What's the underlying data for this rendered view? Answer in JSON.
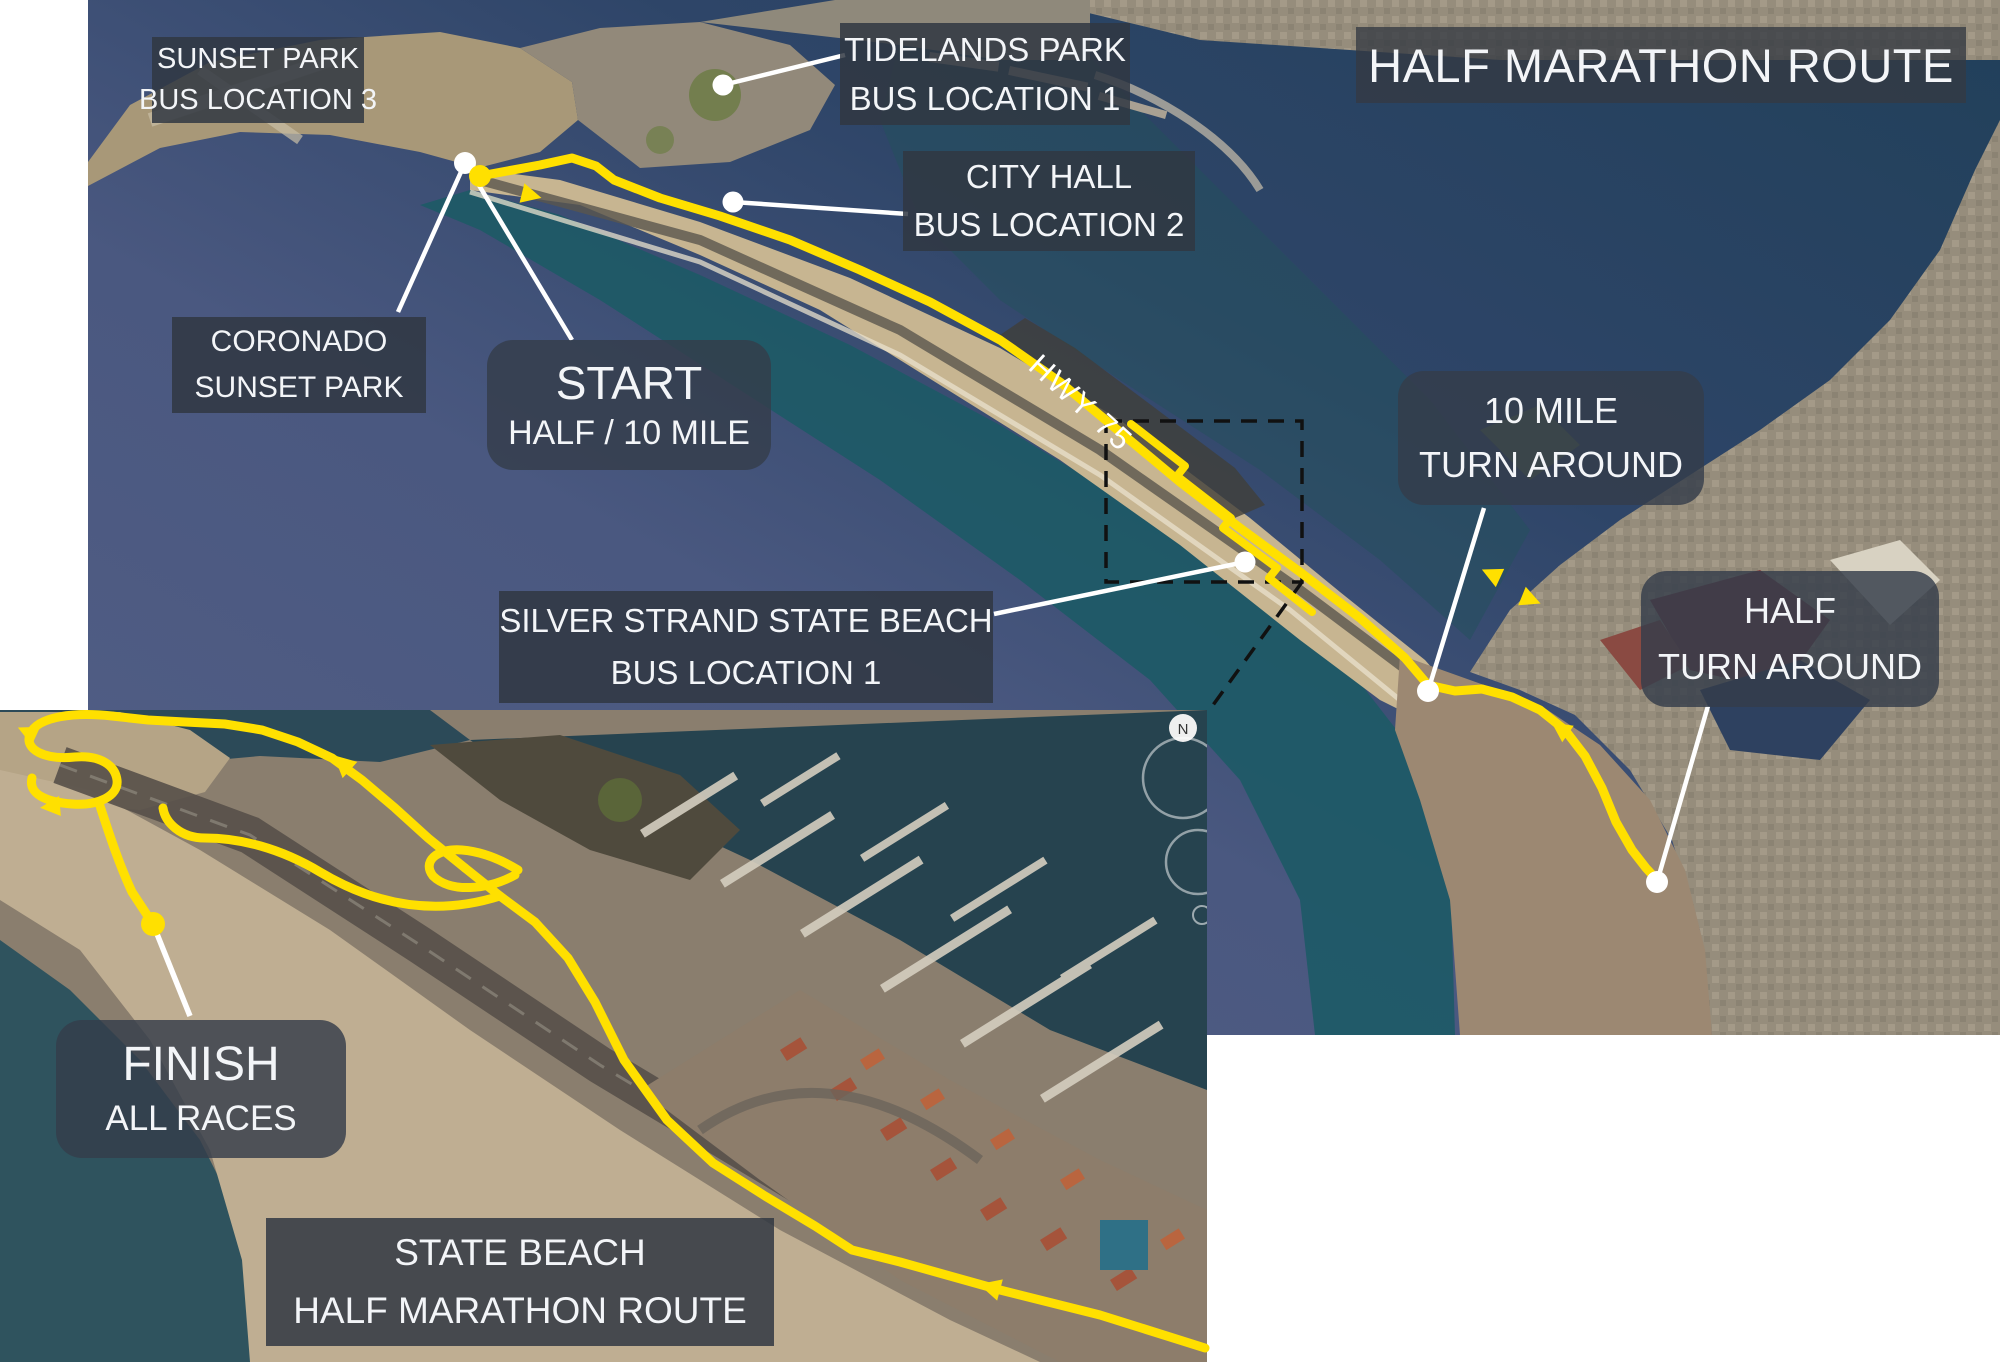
{
  "title": "HALF MARATHON ROUTE",
  "labels": {
    "sunset_park_bus": {
      "line1": "SUNSET PARK",
      "line2": "BUS LOCATION 3"
    },
    "tidelands_park_bus": {
      "line1": "TIDELANDS PARK",
      "line2": "BUS LOCATION 1"
    },
    "city_hall_bus": {
      "line1": "CITY HALL",
      "line2": "BUS LOCATION 2"
    },
    "coronado_sunset_park": {
      "line1": "CORONADO",
      "line2": "SUNSET PARK"
    },
    "start": {
      "line1": "START",
      "line2": "HALF / 10 MILE"
    },
    "hwy_75": "HWY 75",
    "ten_mile_turnaround": {
      "line1": "10 MILE",
      "line2": "TURN AROUND"
    },
    "half_turnaround": {
      "line1": "HALF",
      "line2": "TURN AROUND"
    },
    "silver_strand_bus": {
      "line1": "SILVER STRAND STATE BEACH",
      "line2": "BUS LOCATION 1"
    },
    "finish": {
      "line1": "FINISH",
      "line2": "ALL RACES"
    },
    "state_beach": {
      "line1": "STATE BEACH",
      "line2": "HALF MARATHON ROUTE"
    }
  },
  "inset": {
    "compass_n": "N"
  },
  "colors": {
    "route": "#FFE000",
    "callout": "#FFFFFF",
    "label_bg": "rgba(48,55,66,0.85)",
    "rounded_label_bg": "rgba(52,61,75,0.82)",
    "dashed_box": "#111111"
  }
}
